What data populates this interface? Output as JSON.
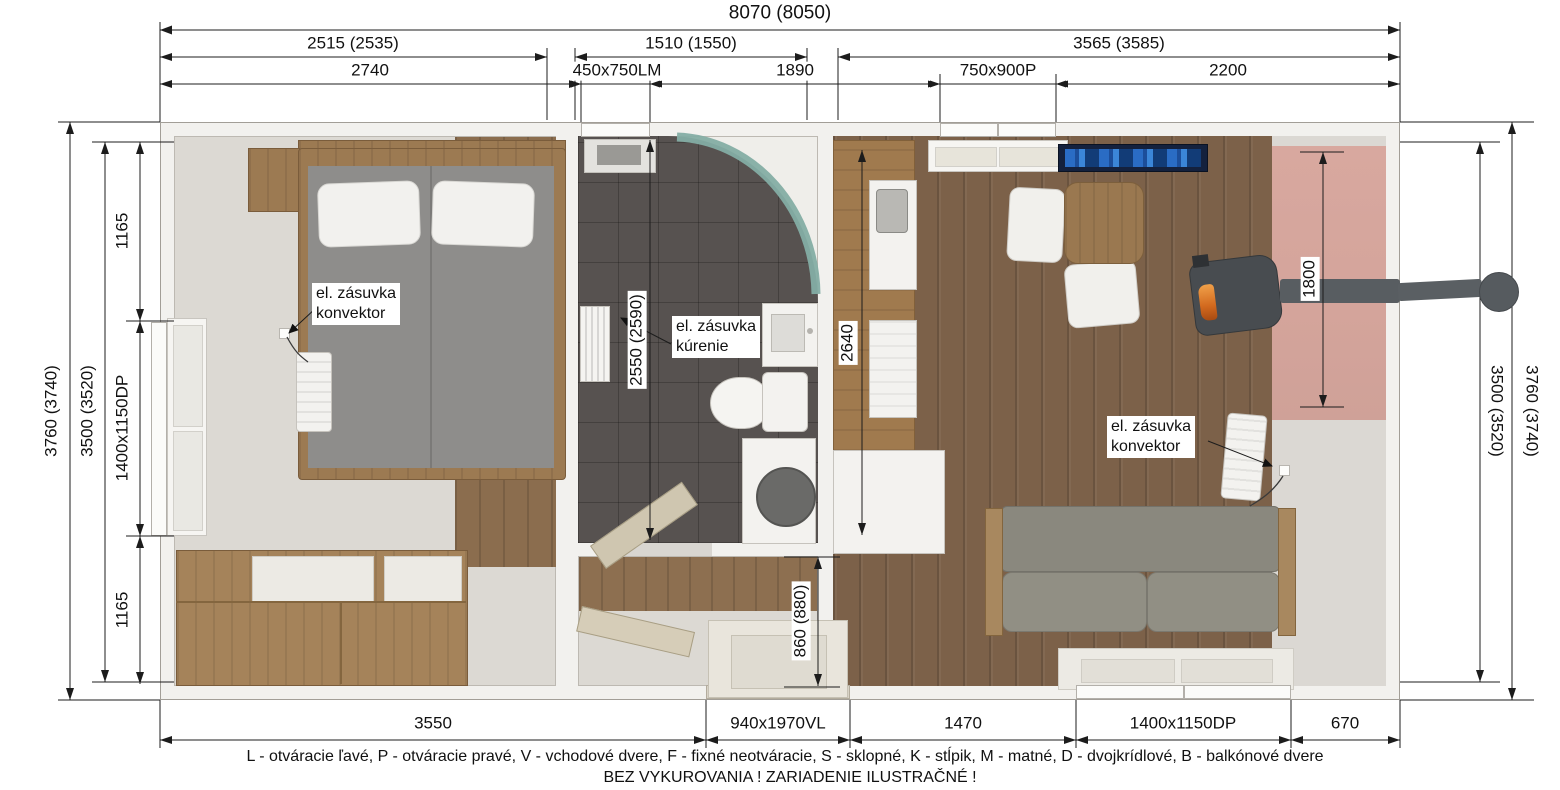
{
  "dimensions": {
    "top": {
      "total": "8070 (8050)",
      "row2": [
        "2515 (2535)",
        "1510 (1550)",
        "3565 (3585)"
      ],
      "row3": [
        "2740",
        "450x750LM",
        "1890",
        "750x900P",
        "2200"
      ]
    },
    "bottom": [
      "3550",
      "940x1970VL",
      "1470",
      "1400x1150DP",
      "670"
    ],
    "left": {
      "outer": "3760 (3740)",
      "inner": "3500 (3520)",
      "segments": [
        "1165",
        "1400x1150DP",
        "1165"
      ]
    },
    "right": {
      "inner": "3500 (3520)",
      "outer": "3760 (3740)"
    },
    "interior": {
      "bathroom_depth": "2550 (2590)",
      "kitchen_run": "2640",
      "accent_wall": "1800",
      "entry_width": "860 (880)"
    }
  },
  "annotations": {
    "socket_convector_bedroom": "el. zásuvka\nkonvektor",
    "socket_heating_bathroom": "el. zásuvka\nkúrenie",
    "socket_convector_living": "el. zásuvka\nkonvektor"
  },
  "legend": {
    "abbreviations": "L - otváracie ľavé, P - otváracie pravé, V - vchodové dvere, F - fixné neotváracie, S - sklopné, K - stĺpik, M - matné, D - dvojkrídlové, B - balkónové dvere",
    "note": "BEZ VYKUROVANIA ! ZARIADENIE ILUSTRAČNÉ !"
  },
  "colors": {
    "accent_wall": "#d4a49b",
    "wood_floor": "#7c6149",
    "tile_floor": "#575250"
  }
}
